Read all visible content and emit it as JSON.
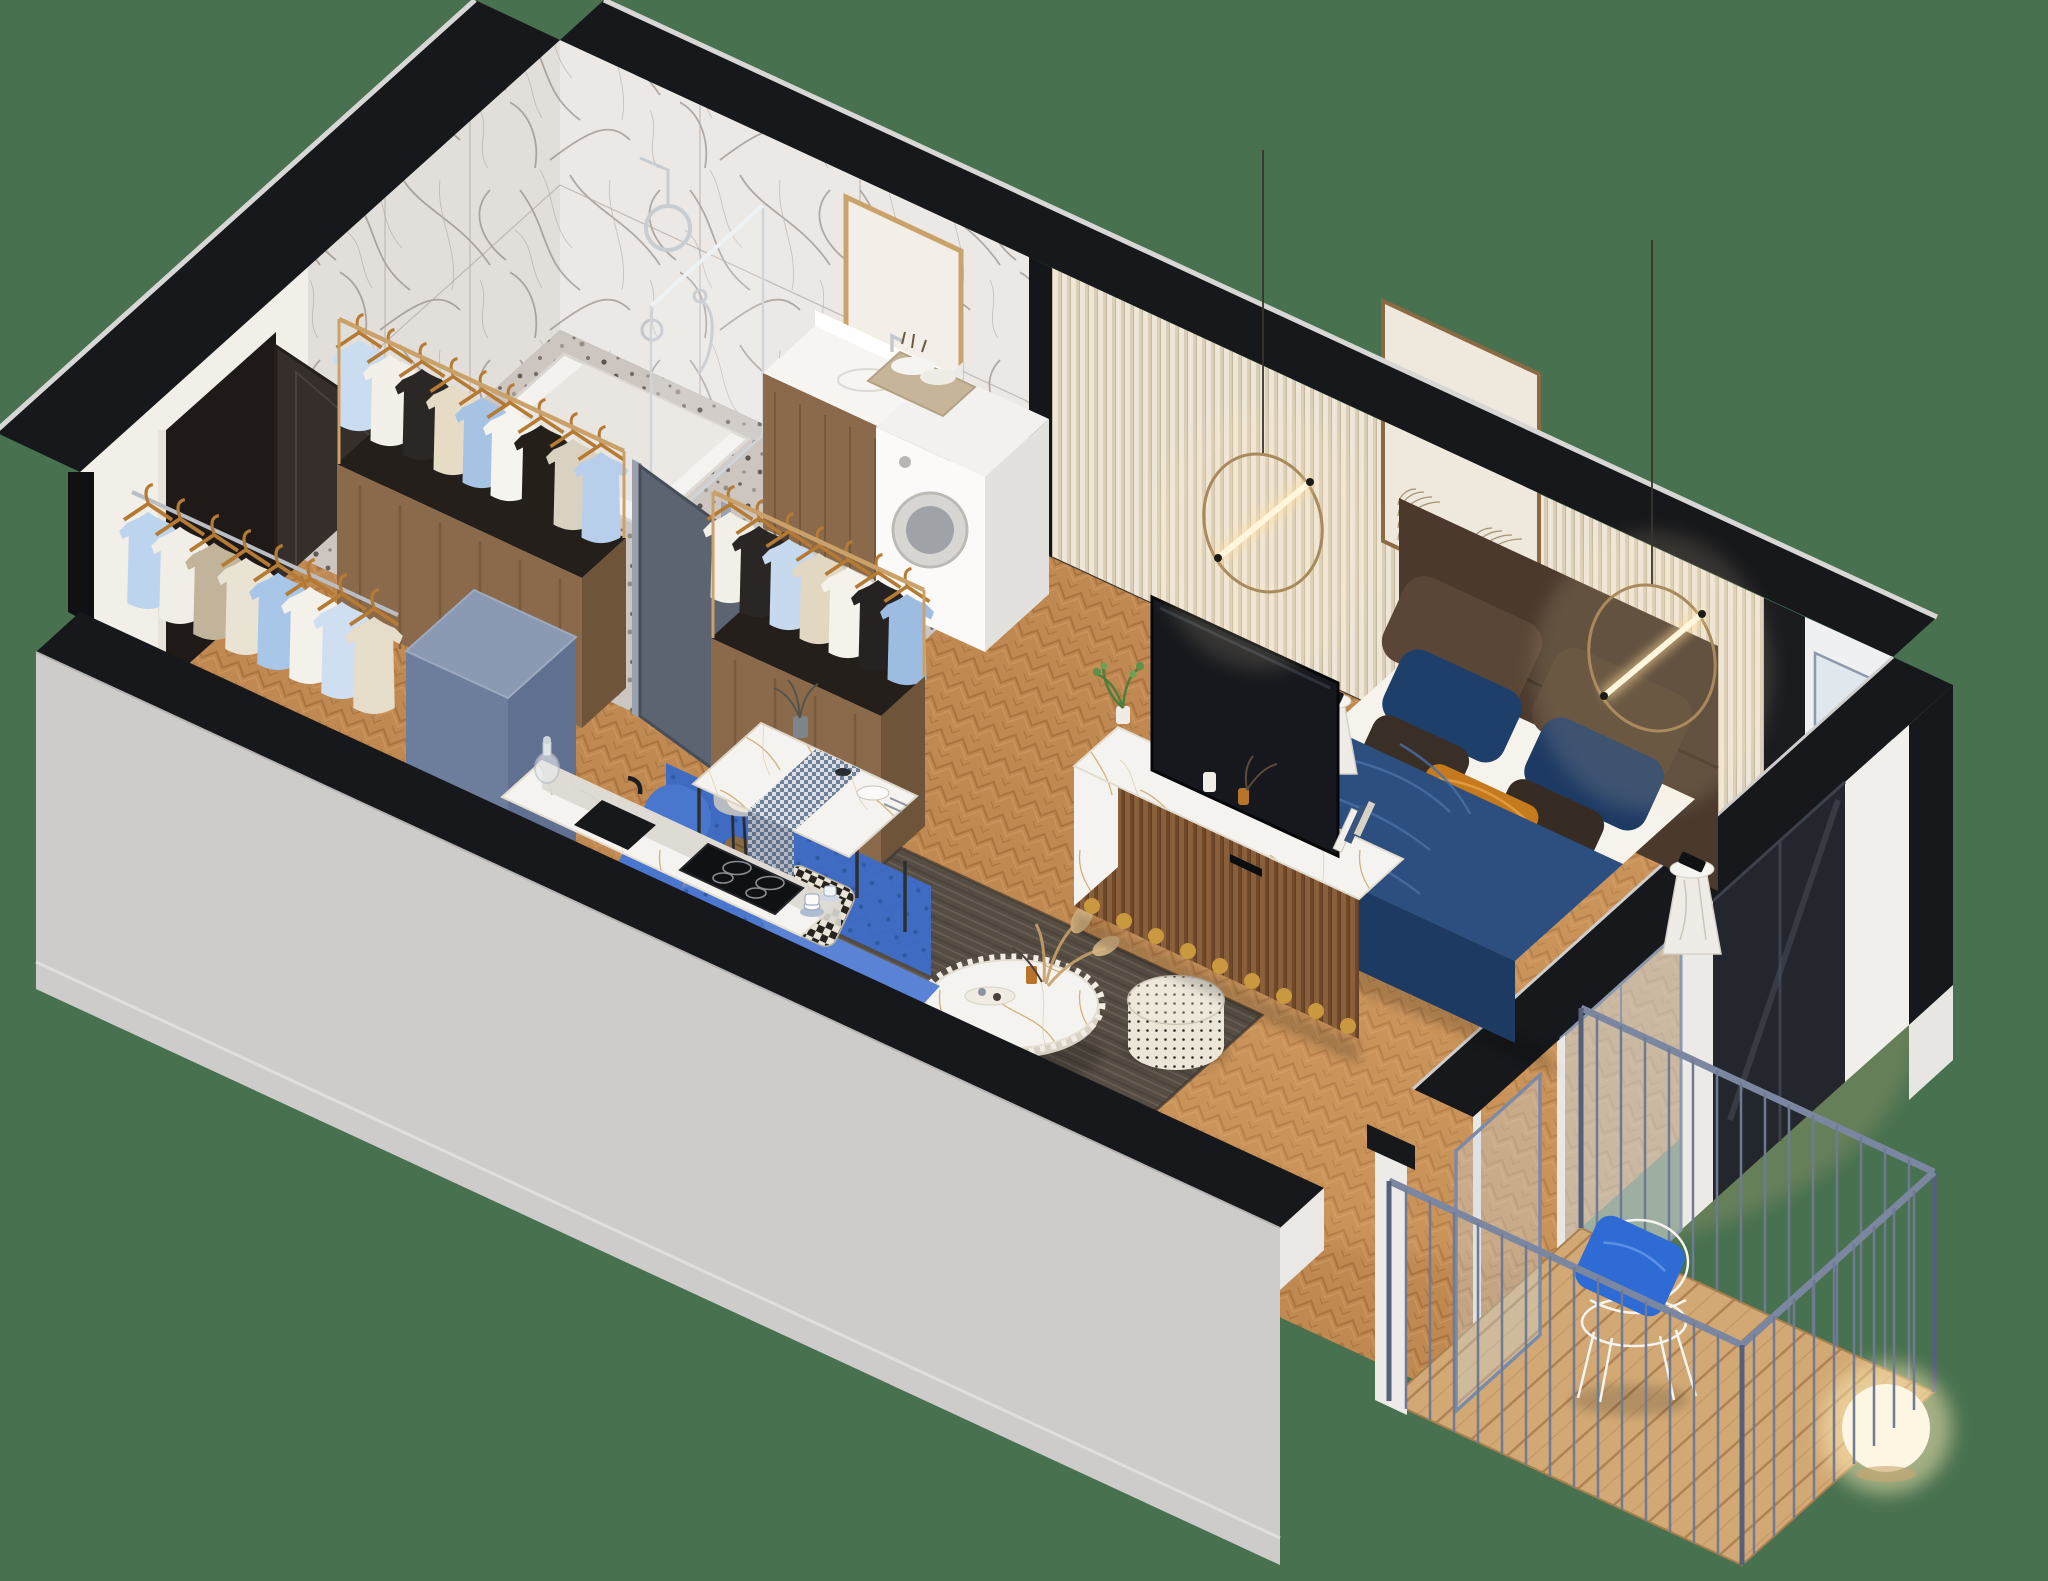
{
  "scene": {
    "type": "3d-isometric-floor-plan-render",
    "description": "Cutaway 3D isometric render of a studio apartment with marble bathroom, entry wardrobe racks, kitchen, dining corner, living area, bedroom and a balcony",
    "background": "#48714f"
  },
  "palette": {
    "background": "#48714f",
    "wallTop": "#17181b",
    "wallOuter": "#cdccca",
    "wallOuterDark": "#c2c1bf",
    "wallWhite": "#f2efe9",
    "marbleBase": "#ebe8e5",
    "ribbedWall": "#efe7d9",
    "woodFloor": "#bf8951",
    "terrazzo": "#d7d1cb",
    "deck": "#d2a974",
    "entryDoor": "#352e2b",
    "bathroomDoor": "#5b6470",
    "fridge": "#6d7e9c",
    "fridgeTop": "#8b9ab2",
    "sofa": "#3f6cc2",
    "sofaLight": "#5a83d6",
    "blanket": "#2c4f7f",
    "rug": "#554d43",
    "headboard": "#4a392c",
    "bedding": "#f6f3ed",
    "orangePillow": "#c67a1e",
    "bluePillow": "#1f3f6b",
    "brownPillow": "#5a4636",
    "consoleWood": "#8a5f3c",
    "rackWood": "#8a6a4a",
    "gold": "#c9a36a",
    "railing": "#7b87a0",
    "tv": "#16181d",
    "balconyPillow": "#2e6bd4",
    "black": "#141414",
    "glow": "#ffe8bd",
    "plant": "#5d9147"
  },
  "rooms": [
    {
      "name": "bathroom",
      "floor": "terrazzo",
      "walls": "white marble with grey veining",
      "items": [
        "walk-in shower",
        "glass shower screen",
        "rain shower head",
        "hand shower",
        "wood vanity with white basin",
        "gold framed mirror",
        "wall-hung toilet reflection",
        "washing machine",
        "towel basket",
        "wood stool with toiletries"
      ]
    },
    {
      "name": "entry",
      "items": [
        "dark entrance door",
        "open wardrobe rack with wooden hangers",
        "second wardrobe rack",
        "wall mounted clothes rail",
        "blue-grey refrigerator box",
        "grey bathroom door with gold handle"
      ]
    },
    {
      "name": "kitchen",
      "items": [
        "white marble counter",
        "black undermount sink with faucet",
        "induction cooktop with four zones",
        "glass decanter",
        "blue and white cups with saucers"
      ]
    },
    {
      "name": "dining",
      "items": [
        "marble dining table",
        "checkered table runner",
        "vase with dried stems",
        "plates and cutlery",
        "two upholstered shell chairs"
      ]
    },
    {
      "name": "living",
      "items": [
        "blue tufted sofa",
        "brown velvet pillow",
        "houndstooth pillow",
        "dark grey rug",
        "round marble coffee table with sawtooth edge",
        "dried pampas grass",
        "candle and tray",
        "patterned pouf",
        "TV sideboard with fluted wood front and gold scalloped base",
        "flat screen TV",
        "books",
        "green plant"
      ]
    },
    {
      "name": "bedroom",
      "items": [
        "double bed with brown upholstered headboard",
        "white bedding",
        "navy quilted throw",
        "velvet pillows in blue and brown",
        "orange accent pillow",
        "two marble pedestal side tables",
        "smartphone",
        "two brass ring pendant lights with glowing tubes",
        "framed line-art print",
        "cream ribbed wall panelling"
      ]
    },
    {
      "name": "balcony",
      "items": [
        "steel railing",
        "diagonal wood deck",
        "white wire chair",
        "blue cushion",
        "glowing sphere floor lamp",
        "sliding glass door leaf"
      ]
    }
  ]
}
